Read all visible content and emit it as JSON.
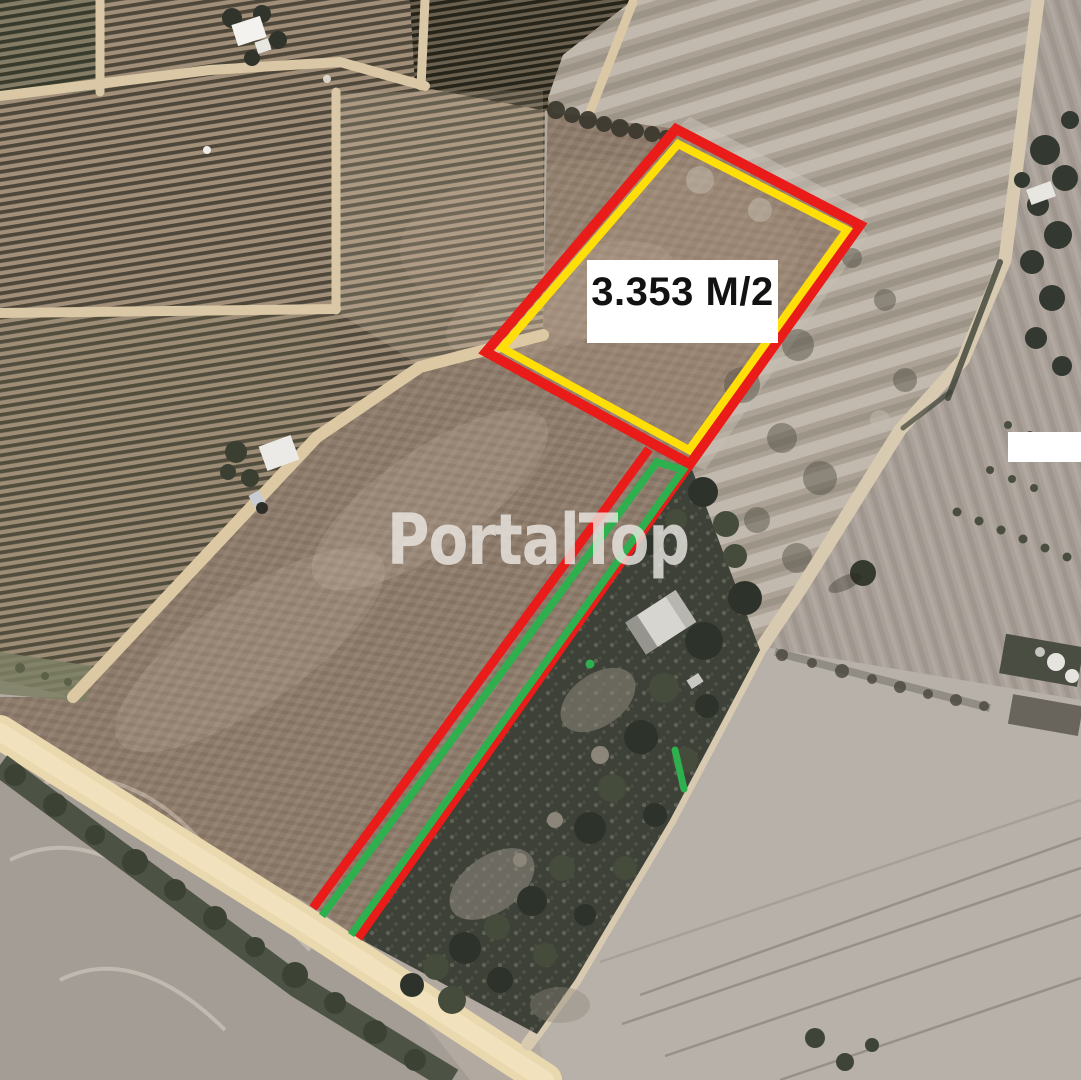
{
  "watermark": {
    "text": "PortalTop",
    "color": "#ece9e4"
  },
  "area_label": {
    "text": "3.353 M/2",
    "background": "#ffffff",
    "text_color": "#121212"
  },
  "overlay": {
    "plot_border_outer": "#ea1c19",
    "plot_border_inner": "#ffdf07",
    "access_strip_outer": "#ea1c19",
    "access_strip_inner": "#2db04d",
    "masked_area": "#ffffff"
  }
}
